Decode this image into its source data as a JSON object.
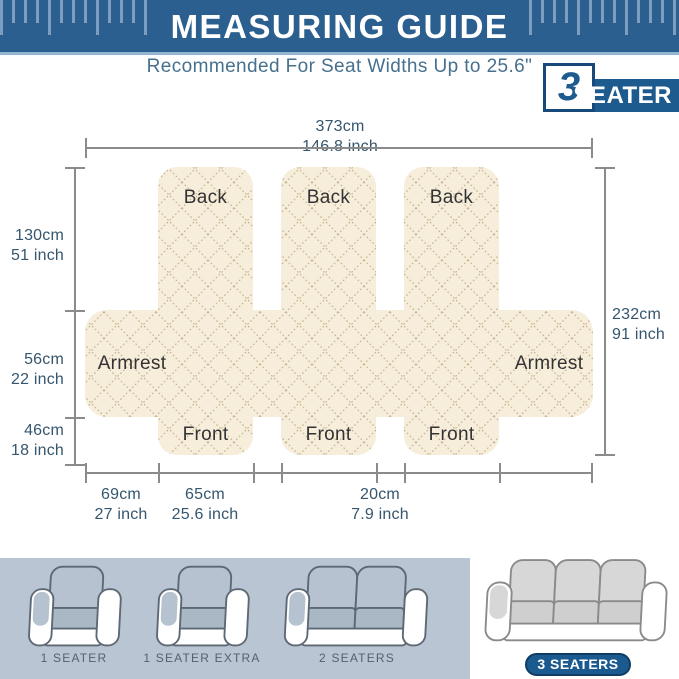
{
  "header": {
    "title": "MEASURING GUIDE",
    "subtitle": "Recommended For Seat Widths Up to 25.6\"",
    "badge_number": "3",
    "badge_label": "SEATER",
    "bg_color": "#2b5f8f",
    "tick_color": "#7d9dbf"
  },
  "diagram": {
    "panel_labels": {
      "back": "Back",
      "armrest": "Armrest",
      "front": "Front"
    },
    "fabric_color": "#f6eedb",
    "stitch_color": "#c9b795",
    "measurements": {
      "top": {
        "cm": "373cm",
        "inch": "146.8 inch"
      },
      "left": [
        {
          "cm": "130cm",
          "inch": "51 inch"
        },
        {
          "cm": "56cm",
          "inch": "22 inch"
        },
        {
          "cm": "46cm",
          "inch": "18 inch"
        }
      ],
      "right": {
        "cm": "232cm",
        "inch": "91 inch"
      },
      "bottom": [
        {
          "cm": "69cm",
          "inch": "27 inch"
        },
        {
          "cm": "65cm",
          "inch": "25.6 inch"
        },
        {
          "cm": "20cm",
          "inch": "7.9 inch"
        }
      ]
    }
  },
  "variants": {
    "items": [
      {
        "label": "1 SEATER",
        "highlighted": false
      },
      {
        "label": "1 SEATER EXTRA",
        "highlighted": false
      },
      {
        "label": "2 SEATERS",
        "highlighted": false
      },
      {
        "label": "3 SEATERS",
        "highlighted": true
      }
    ]
  }
}
